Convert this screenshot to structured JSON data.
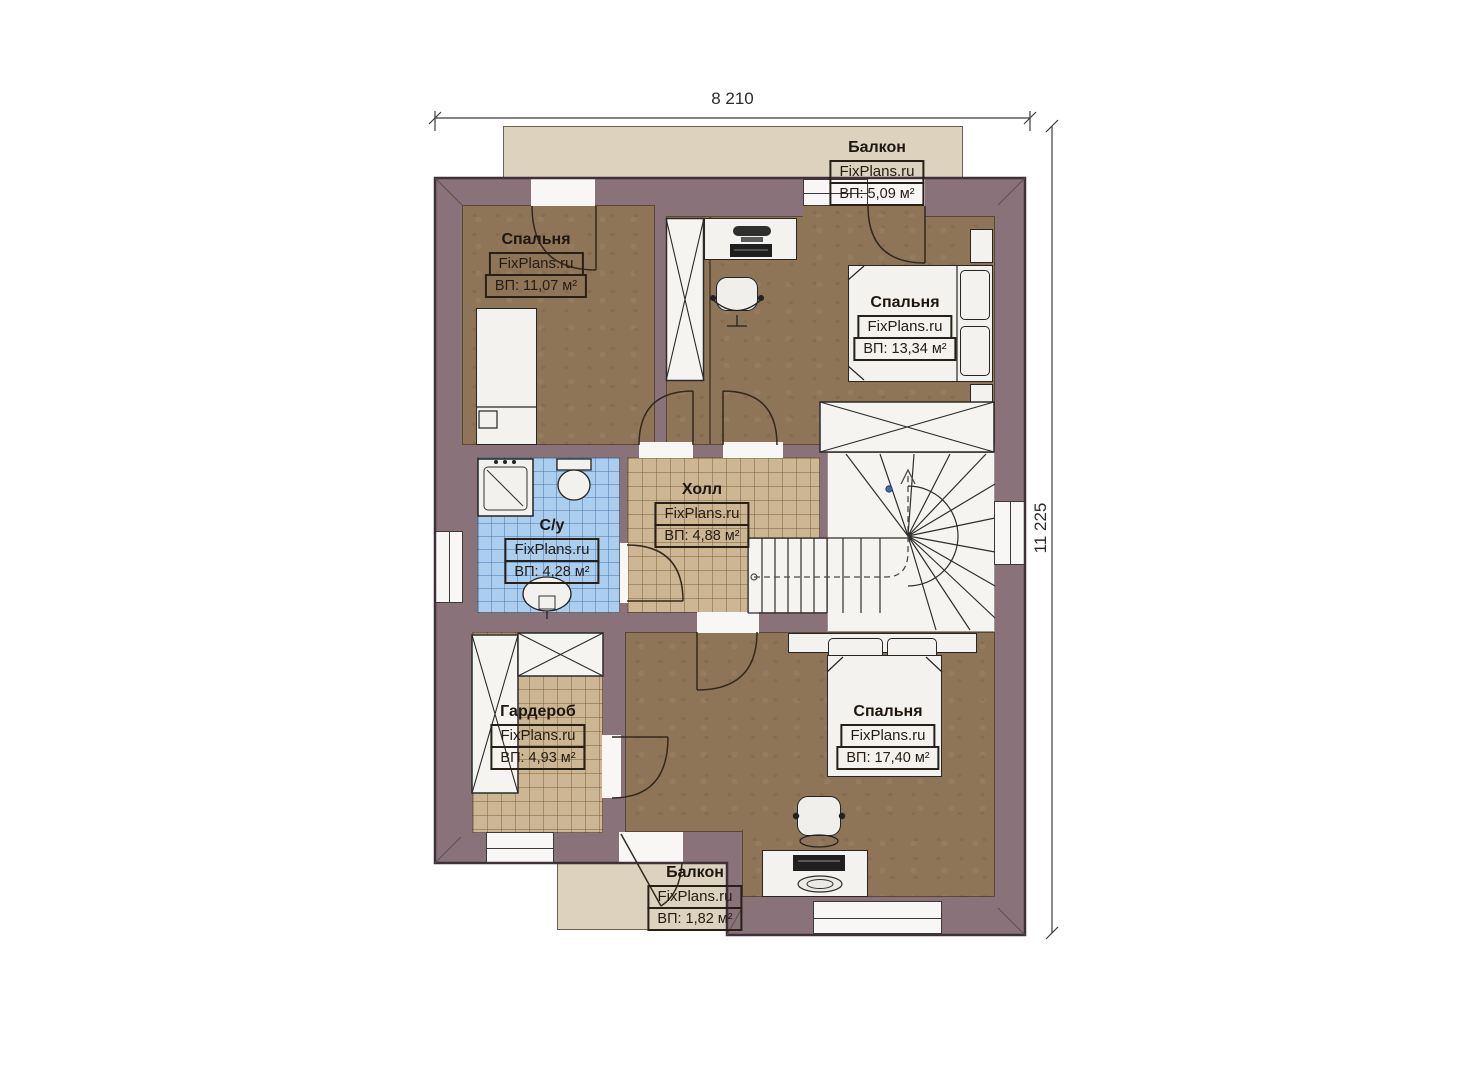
{
  "plan": {
    "brand": "FixPlans.ru",
    "dimensions": {
      "width": "8 210",
      "height": "11 225"
    },
    "rooms": [
      {
        "id": "balcony-top",
        "name": "Балкон",
        "area": "ВП: 5,09 м²"
      },
      {
        "id": "bedroom-top-left",
        "name": "Спальня",
        "area": "ВП: 11,07 м²"
      },
      {
        "id": "bedroom-top-right",
        "name": "Спальня",
        "area": "ВП: 13,34 м²"
      },
      {
        "id": "bathroom",
        "name": "С/у",
        "area": "ВП: 4,28 м²"
      },
      {
        "id": "hall",
        "name": "Холл",
        "area": "ВП: 4,88 м²"
      },
      {
        "id": "wardrobe",
        "name": "Гардероб",
        "area": "ВП: 4,93 м²"
      },
      {
        "id": "bedroom-bottom",
        "name": "Спальня",
        "area": "ВП: 17,40 м²"
      },
      {
        "id": "balcony-bottom",
        "name": "Балкон",
        "area": "ВП: 1,82 м²"
      }
    ],
    "colors": {
      "wall": "#8a727a",
      "floor_room": "#8e7557",
      "floor_tile": "#cdb694",
      "floor_bath": "#abceee",
      "balcony": "#ddd2bd",
      "fixture": "#f3f2ef"
    }
  }
}
